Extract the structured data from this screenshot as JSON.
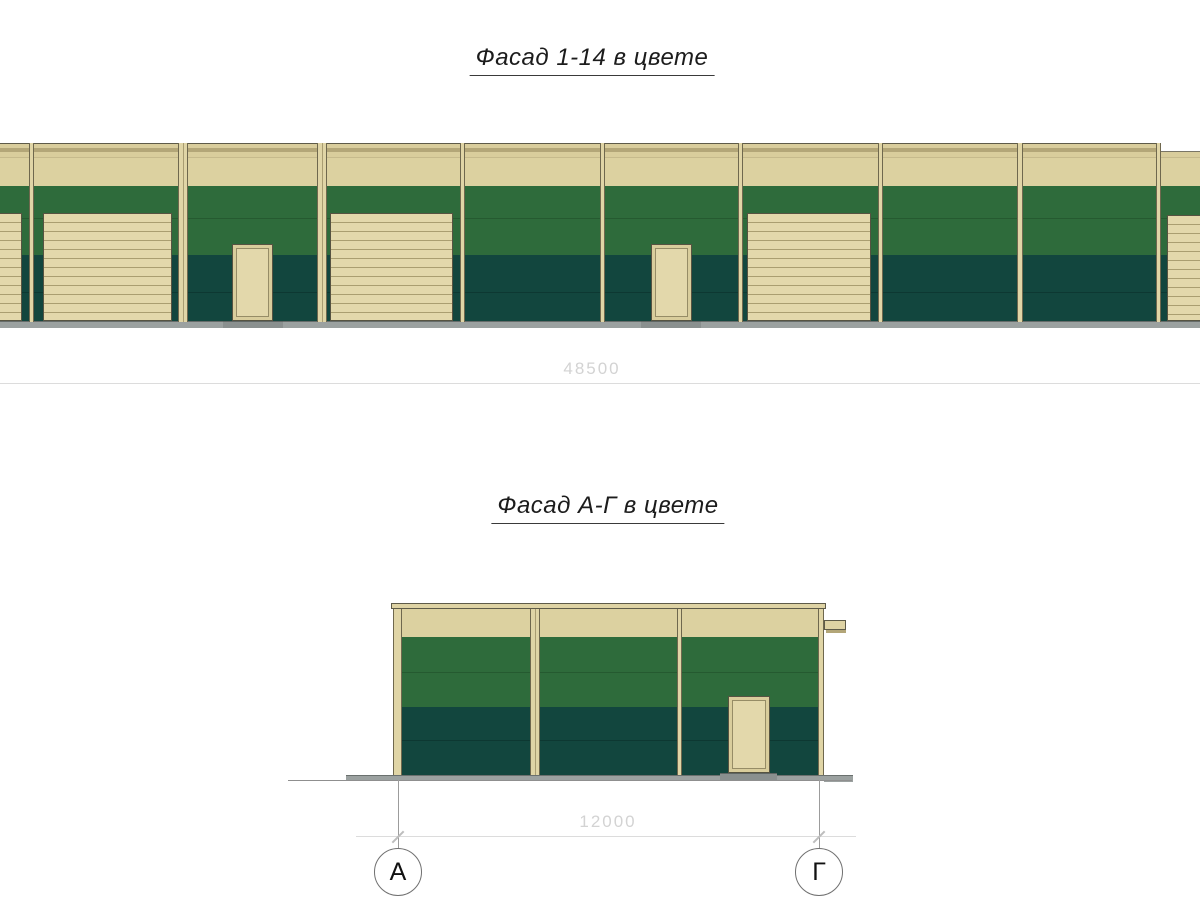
{
  "colors": {
    "wall_cream": "#dcd1a0",
    "door_cream": "#e3d8ab",
    "green_upper": "#2e6b3b",
    "green_lower": "#12463e",
    "plinth_gray": "#9ba1a0",
    "outline": "#565341",
    "dimension_gray": "#d3d3d3"
  },
  "facade1": {
    "title": "Фасад 1-14 в цвете",
    "dimension_label": "48500",
    "rects": [
      {
        "kind": "parapet",
        "name": "parapet-band",
        "x": 0,
        "y": 143,
        "w": 1200,
        "h": 43
      },
      {
        "kind": "gmid",
        "name": "green-panel-upper",
        "x": 0,
        "y": 186,
        "w": 1200,
        "h": 32
      },
      {
        "kind": "gmid seam",
        "name": "green-panel-upper-2",
        "x": 0,
        "y": 218,
        "w": 1200,
        "h": 37
      },
      {
        "kind": "gdark",
        "name": "green-panel-lower",
        "x": 0,
        "y": 255,
        "w": 1200,
        "h": 37
      },
      {
        "kind": "gdark seam",
        "name": "green-panel-lower-2",
        "x": 0,
        "y": 292,
        "w": 1200,
        "h": 29
      },
      {
        "kind": "plinth",
        "name": "plinth-strip",
        "x": 0,
        "y": 321,
        "w": 1200,
        "h": 7
      },
      {
        "kind": "garage",
        "name": "garage-door",
        "x": -30,
        "y": 213,
        "w": 52,
        "h": 108
      },
      {
        "kind": "garage",
        "name": "garage-door",
        "x": 43,
        "y": 213,
        "w": 129,
        "h": 108
      },
      {
        "kind": "garage",
        "name": "garage-door",
        "x": 330,
        "y": 213,
        "w": 123,
        "h": 108
      },
      {
        "kind": "garage",
        "name": "garage-door",
        "x": 747,
        "y": 213,
        "w": 124,
        "h": 108
      },
      {
        "kind": "garage",
        "name": "garage-door",
        "x": 1167,
        "y": 215,
        "w": 80,
        "h": 106
      },
      {
        "kind": "threshold",
        "name": "door-threshold",
        "x": 223,
        "y": 321,
        "w": 60,
        "h": 7
      },
      {
        "kind": "threshold",
        "name": "door-threshold",
        "x": 641,
        "y": 321,
        "w": 60,
        "h": 7
      },
      {
        "kind": "door",
        "name": "entry-door",
        "x": 232,
        "y": 244,
        "w": 41,
        "h": 77
      },
      {
        "kind": "door",
        "name": "entry-door",
        "x": 651,
        "y": 244,
        "w": 41,
        "h": 77
      },
      {
        "kind": "step-white",
        "name": "parapet-step",
        "x": 1161,
        "y": 139,
        "w": 39,
        "h": 13
      },
      {
        "kind": "pilaster",
        "name": "column-pilaster",
        "x": 29,
        "y": 143,
        "w": 5,
        "h": 179
      },
      {
        "kind": "pilaster wide",
        "name": "column-pilaster",
        "x": 178,
        "y": 143,
        "w": 10,
        "h": 179
      },
      {
        "kind": "pilaster wide",
        "name": "column-pilaster",
        "x": 317,
        "y": 143,
        "w": 10,
        "h": 179
      },
      {
        "kind": "pilaster",
        "name": "column-pilaster",
        "x": 460,
        "y": 143,
        "w": 5,
        "h": 179
      },
      {
        "kind": "pilaster",
        "name": "column-pilaster",
        "x": 600,
        "y": 143,
        "w": 5,
        "h": 179
      },
      {
        "kind": "pilaster",
        "name": "column-pilaster",
        "x": 738,
        "y": 143,
        "w": 5,
        "h": 179
      },
      {
        "kind": "pilaster",
        "name": "column-pilaster",
        "x": 878,
        "y": 143,
        "w": 5,
        "h": 179
      },
      {
        "kind": "pilaster",
        "name": "column-pilaster",
        "x": 1017,
        "y": 143,
        "w": 6,
        "h": 179
      },
      {
        "kind": "pilaster",
        "name": "column-pilaster",
        "x": 1156,
        "y": 143,
        "w": 5,
        "h": 179
      }
    ]
  },
  "facade2": {
    "title": "Фасад А-Г в цвете",
    "dimension_label": "12000",
    "axes": [
      {
        "label": "А",
        "x": 398
      },
      {
        "label": "Г",
        "x": 819
      }
    ],
    "rects": [
      {
        "kind": "parapet2",
        "name": "parapet-band",
        "x": 393,
        "y": 609,
        "w": 431,
        "h": 28
      },
      {
        "kind": "gmid",
        "name": "green-panel-upper",
        "x": 393,
        "y": 637,
        "w": 431,
        "h": 35
      },
      {
        "kind": "gmid seam",
        "name": "green-panel-upper-2",
        "x": 393,
        "y": 672,
        "w": 431,
        "h": 35
      },
      {
        "kind": "gdark",
        "name": "green-panel-lower",
        "x": 393,
        "y": 707,
        "w": 431,
        "h": 33
      },
      {
        "kind": "gdark seam",
        "name": "green-panel-lower-2",
        "x": 393,
        "y": 740,
        "w": 431,
        "h": 35
      },
      {
        "kind": "apron",
        "name": "ground-apron",
        "x": 346,
        "y": 775,
        "w": 47,
        "h": 6
      },
      {
        "kind": "apron",
        "name": "ground-apron",
        "x": 393,
        "y": 775,
        "w": 431,
        "h": 5
      },
      {
        "kind": "apron",
        "name": "ground-apron",
        "x": 824,
        "y": 775,
        "w": 29,
        "h": 7
      },
      {
        "kind": "threshold",
        "name": "door-threshold",
        "x": 720,
        "y": 773,
        "w": 57,
        "h": 7
      },
      {
        "kind": "door",
        "name": "entry-door",
        "x": 728,
        "y": 696,
        "w": 42,
        "h": 77
      },
      {
        "kind": "pilaster",
        "name": "corner-pilaster",
        "x": 393,
        "y": 608,
        "w": 9,
        "h": 167
      },
      {
        "kind": "pilaster wide",
        "name": "column-pilaster",
        "x": 530,
        "y": 608,
        "w": 10,
        "h": 167
      },
      {
        "kind": "pilaster",
        "name": "column-pilaster",
        "x": 677,
        "y": 608,
        "w": 5,
        "h": 167
      },
      {
        "kind": "pilaster",
        "name": "corner-pilaster",
        "x": 818,
        "y": 608,
        "w": 6,
        "h": 167
      },
      {
        "kind": "coping",
        "name": "parapet-coping",
        "x": 391,
        "y": 603,
        "w": 435,
        "h": 6
      },
      {
        "kind": "scupper",
        "name": "rain-scupper",
        "x": 824,
        "y": 620,
        "w": 22,
        "h": 10
      },
      {
        "kind": "scupper-shadow",
        "name": "rain-scupper-shadow",
        "x": 826,
        "y": 630,
        "w": 20,
        "h": 3
      },
      {
        "kind": "groundline",
        "name": "ground-line",
        "x": 288,
        "y": 780,
        "w": 564,
        "h": 1
      }
    ]
  }
}
